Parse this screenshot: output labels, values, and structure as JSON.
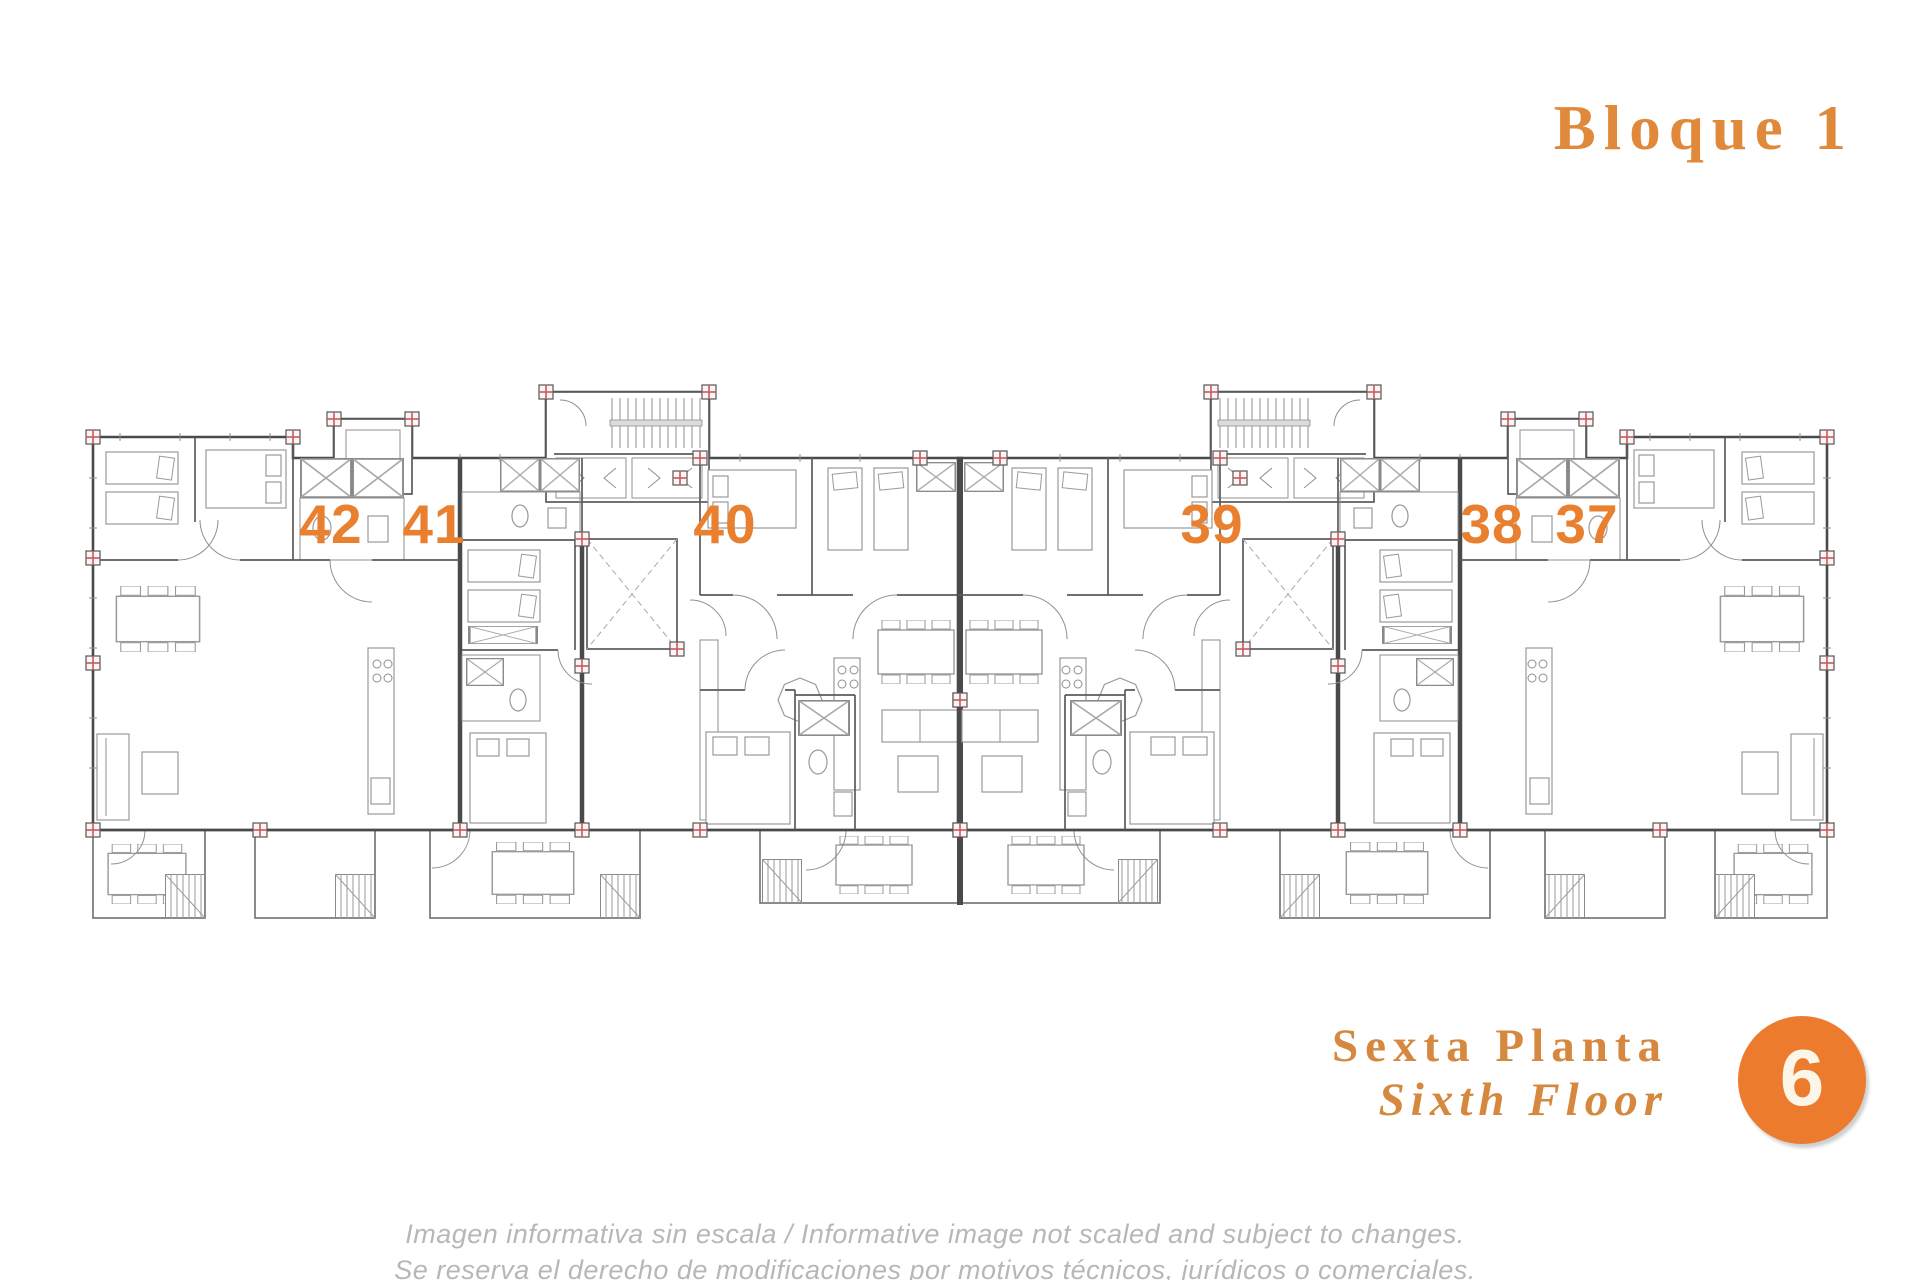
{
  "header": {
    "title": "Bloque 1"
  },
  "plan": {
    "unit_numbers": [
      "42",
      "41",
      "40",
      "39",
      "38",
      "37"
    ],
    "features": {
      "stair_core": "staircase with elevator cells",
      "elevator_shaft": "elevator shaft",
      "lightwell": "open void marked with cross",
      "column_marker": "structural column (red cross)",
      "terrace": "terrace with table and stairs"
    }
  },
  "floor": {
    "name_es": "Sexta Planta",
    "name_en": "Sixth Floor",
    "number": "6"
  },
  "disclaimer": {
    "line1": "Imagen informativa sin escala /  Informative image not scaled and subject to changes.",
    "line2": "Se reserva el derecho de modificaciones por motivos técnicos, jurídicos o comerciales."
  },
  "colors": {
    "accent_orange": "#E8802F",
    "title_orange": "#E0893B",
    "floor_label_orange": "#D5883E",
    "badge_orange": "#ED7B2E",
    "wall_gray": "#4A4A4A",
    "furniture_gray": "#9A9A9A",
    "column_marker_red": "#C35B5B",
    "disclaimer_gray": "#B7B7B7"
  }
}
